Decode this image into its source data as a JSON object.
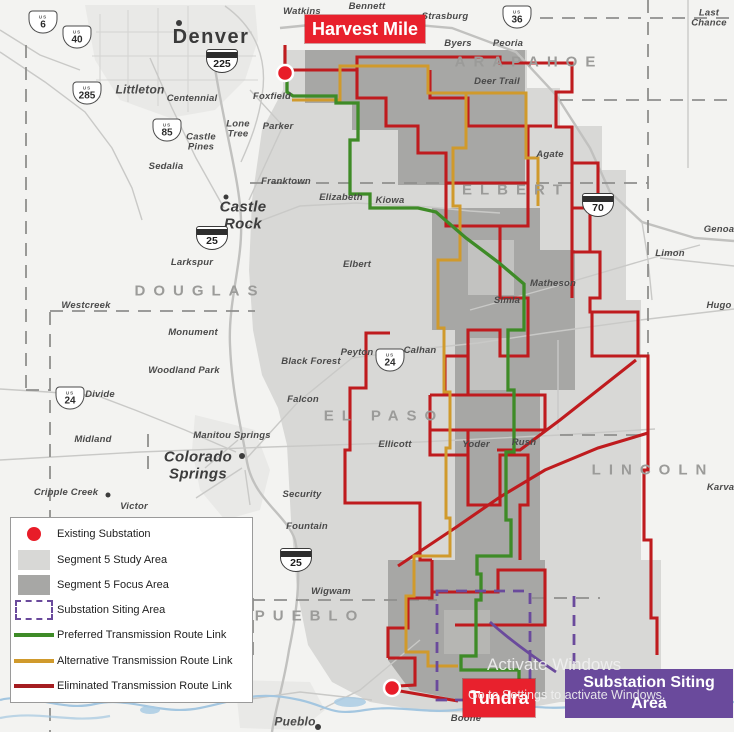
{
  "callouts": {
    "harvest_mile": "Harvest Mile",
    "tundra": "Tundra",
    "siting_area": "Substation Siting\nArea"
  },
  "legend": {
    "items": [
      {
        "swatch": "dot",
        "label": "Existing Substation"
      },
      {
        "swatch": "study",
        "label": "Segment 5 Study Area"
      },
      {
        "swatch": "focus",
        "label": "Segment 5 Focus Area"
      },
      {
        "swatch": "siting",
        "label": "Substation Siting Area"
      },
      {
        "swatch": "green-line",
        "label": "Preferred Transmission Route Link"
      },
      {
        "swatch": "orange-line",
        "label": "Alternative Transmission Route Link"
      },
      {
        "swatch": "red-line",
        "label": "Eliminated Transmission Route Link"
      }
    ]
  },
  "watermark": {
    "line1": "Activate Windows",
    "line2": "Go to Settings to activate Windows."
  },
  "colors": {
    "study_area": "#d8d8d6",
    "focus_area": "#a7a7a5",
    "preferred_route": "#3e8b27",
    "alternative_route": "#d09a2c",
    "eliminated_route": "#bf1b1e",
    "callout_red": "#e8212d",
    "siting_purple": "#6a4a9c"
  },
  "map": {
    "shield_us_caption": "US",
    "counties": [
      {
        "t": "ARAPAHOE",
        "x": 529,
        "y": 62
      },
      {
        "t": "ELBERT",
        "x": 516,
        "y": 190
      },
      {
        "t": "DOUGLAS",
        "x": 200,
        "y": 291
      },
      {
        "t": "EL PASO",
        "x": 384,
        "y": 416
      },
      {
        "t": "LINCOLN",
        "x": 653,
        "y": 470
      },
      {
        "t": "PUEBLO",
        "x": 310,
        "y": 616
      }
    ],
    "cities": [
      {
        "t": "Denver",
        "x": 211,
        "y": 37,
        "s": "xl"
      },
      {
        "t": "Watkins",
        "x": 302,
        "y": 12
      },
      {
        "t": "Bennett",
        "x": 367,
        "y": 7
      },
      {
        "t": "Strasburg",
        "x": 445,
        "y": 17
      },
      {
        "t": "Byers",
        "x": 458,
        "y": 44
      },
      {
        "t": "Peoria",
        "x": 508,
        "y": 44
      },
      {
        "t": "Deer Trail",
        "x": 497,
        "y": 82
      },
      {
        "t": "Last\nChance",
        "x": 709,
        "y": 19
      },
      {
        "t": "Agate",
        "x": 550,
        "y": 155
      },
      {
        "t": "Littleton",
        "x": 140,
        "y": 90,
        "s": "m"
      },
      {
        "t": "Centennial",
        "x": 192,
        "y": 99
      },
      {
        "t": "Foxfield",
        "x": 272,
        "y": 97
      },
      {
        "t": "Lone\nTree",
        "x": 238,
        "y": 130
      },
      {
        "t": "Parker",
        "x": 278,
        "y": 127
      },
      {
        "t": "Castle\nPines",
        "x": 201,
        "y": 143
      },
      {
        "t": "Sedalia",
        "x": 166,
        "y": 167
      },
      {
        "t": "Franktown",
        "x": 286,
        "y": 182
      },
      {
        "t": "Elizabeth",
        "x": 341,
        "y": 198
      },
      {
        "t": "Kiowa",
        "x": 390,
        "y": 201
      },
      {
        "t": "Castle\nRock",
        "x": 243,
        "y": 216,
        "s": "l"
      },
      {
        "t": "Larkspur",
        "x": 192,
        "y": 263
      },
      {
        "t": "Elbert",
        "x": 357,
        "y": 265
      },
      {
        "t": "Westcreek",
        "x": 86,
        "y": 306
      },
      {
        "t": "Monument",
        "x": 193,
        "y": 333
      },
      {
        "t": "Woodland Park",
        "x": 184,
        "y": 371
      },
      {
        "t": "Black Forest",
        "x": 311,
        "y": 362
      },
      {
        "t": "Peyton",
        "x": 357,
        "y": 353
      },
      {
        "t": "Calhan",
        "x": 420,
        "y": 351
      },
      {
        "t": "Divide",
        "x": 100,
        "y": 395
      },
      {
        "t": "Falcon",
        "x": 303,
        "y": 400
      },
      {
        "t": "Midland",
        "x": 93,
        "y": 440
      },
      {
        "t": "Manitou Springs",
        "x": 232,
        "y": 436
      },
      {
        "t": "Colorado\nSprings",
        "x": 198,
        "y": 466,
        "s": "l"
      },
      {
        "t": "Ellicott",
        "x": 395,
        "y": 445
      },
      {
        "t": "Yoder",
        "x": 476,
        "y": 445
      },
      {
        "t": "Rush",
        "x": 524,
        "y": 443
      },
      {
        "t": "Simla",
        "x": 507,
        "y": 301
      },
      {
        "t": "Matheson",
        "x": 553,
        "y": 284
      },
      {
        "t": "Genoa",
        "x": 719,
        "y": 230
      },
      {
        "t": "Limon",
        "x": 670,
        "y": 254
      },
      {
        "t": "Hugo",
        "x": 719,
        "y": 306
      },
      {
        "t": "Karval",
        "x": 722,
        "y": 488
      },
      {
        "t": "Cripple Creek",
        "x": 66,
        "y": 493
      },
      {
        "t": "Victor",
        "x": 134,
        "y": 507
      },
      {
        "t": "Security",
        "x": 302,
        "y": 495
      },
      {
        "t": "Fountain",
        "x": 307,
        "y": 527
      },
      {
        "t": "Wigwam",
        "x": 331,
        "y": 592
      },
      {
        "t": "Boone",
        "x": 466,
        "y": 719
      },
      {
        "t": "Pueblo",
        "x": 295,
        "y": 722,
        "s": "m"
      }
    ],
    "shields": [
      {
        "type": "us",
        "num": "6",
        "x": 43,
        "y": 22
      },
      {
        "type": "us",
        "num": "40",
        "x": 77,
        "y": 37
      },
      {
        "type": "us",
        "num": "285",
        "x": 87,
        "y": 93
      },
      {
        "type": "us",
        "num": "85",
        "x": 167,
        "y": 130
      },
      {
        "type": "i",
        "num": "225",
        "x": 222,
        "y": 61
      },
      {
        "type": "i",
        "num": "25",
        "x": 212,
        "y": 238
      },
      {
        "type": "us",
        "num": "36",
        "x": 517,
        "y": 17
      },
      {
        "type": "us",
        "num": "24",
        "x": 70,
        "y": 398
      },
      {
        "type": "us",
        "num": "24",
        "x": 390,
        "y": 360
      },
      {
        "type": "i",
        "num": "70",
        "x": 598,
        "y": 205
      },
      {
        "type": "i",
        "num": "25",
        "x": 296,
        "y": 560
      }
    ]
  }
}
